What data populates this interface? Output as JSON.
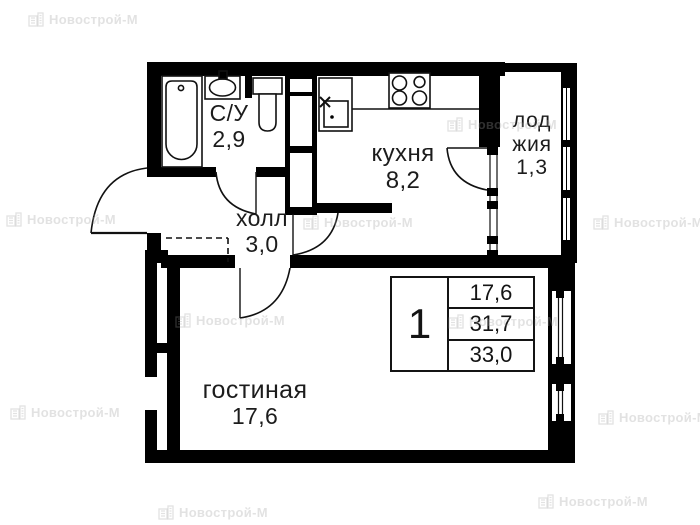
{
  "watermark": {
    "text": "Новострой-М"
  },
  "plan": {
    "rooms": {
      "bathroom": {
        "name": "С/У",
        "area": "2,9"
      },
      "hall": {
        "name": "холл",
        "area": "3,0"
      },
      "kitchen": {
        "name": "кухня",
        "area": "8,2"
      },
      "loggia": {
        "line1": "лод",
        "line2": "жия",
        "area": "1,3"
      },
      "living": {
        "name": "гостиная",
        "area": "17,6"
      }
    },
    "info_table": {
      "rooms": "1",
      "values": [
        "17,6",
        "31,7",
        "33,0"
      ]
    }
  }
}
